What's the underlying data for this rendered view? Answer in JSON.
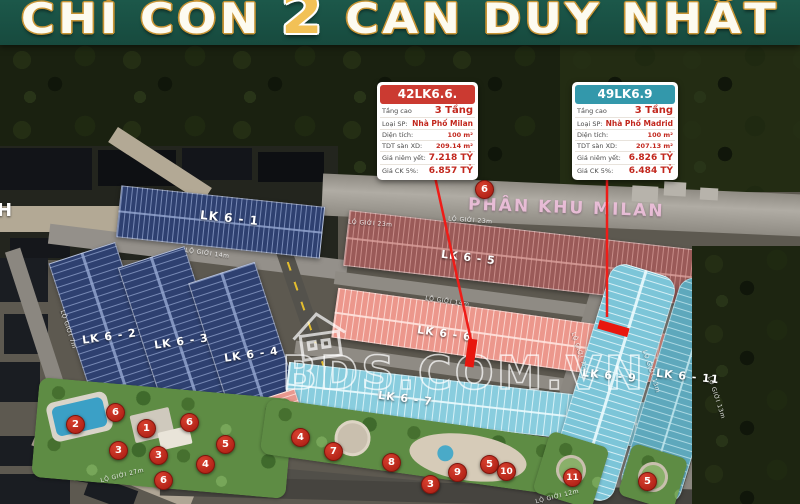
{
  "banner": {
    "prefix": "CHỈ CÒN",
    "highlight": "2",
    "suffix": "CĂN DUY NHẤT"
  },
  "zone_label": "PHÂN KHU MILAN",
  "watermark_text": "BDS.COM.VN",
  "edge_letter": "H",
  "cards": [
    {
      "title": "42LK6.6.",
      "header_color": "#cb3a31",
      "rows": [
        {
          "label": "Tầng cao",
          "value": "3 Tầng"
        },
        {
          "label": "Loại SP:",
          "value": "Nhà Phố Milan"
        },
        {
          "label": "Diện tích:",
          "value": "100 m²"
        },
        {
          "label": "TDT sàn XD:",
          "value": "209.14 m²"
        },
        {
          "label": "Giá niêm yết:",
          "value": "7.218 TỶ"
        },
        {
          "label": "Giá CK 5%:",
          "value": "6.857 TỶ"
        }
      ]
    },
    {
      "title": "49LK6.9",
      "header_color": "#3398ab",
      "rows": [
        {
          "label": "Tầng cao",
          "value": "3 Tầng"
        },
        {
          "label": "Loại SP:",
          "value": "Nhà Phố Madrid"
        },
        {
          "label": "Diện tích:",
          "value": "100 m²"
        },
        {
          "label": "TDT sàn XD:",
          "value": "207.13 m²"
        },
        {
          "label": "Giá niêm yết:",
          "value": "6.826 TỶ"
        },
        {
          "label": "Giá CK 5%:",
          "value": "6.484 TỶ"
        }
      ]
    }
  ],
  "blocks": [
    {
      "label": "LK 6 - 1"
    },
    {
      "label": "LK 6 - 2"
    },
    {
      "label": "LK 6 - 3"
    },
    {
      "label": "LK 6 - 4"
    },
    {
      "label": "LK 6 - 5"
    },
    {
      "label": "LK 6 - 6"
    },
    {
      "label": "LK 6 - 7"
    },
    {
      "label": "LK 6 - 9"
    },
    {
      "label": "LK 6 - 11"
    }
  ],
  "street_labels": [
    "LỘ GIỚI 23m",
    "LỘ GIỚI 23m",
    "LỘ GIỚI 14m",
    "LỘ GIỚI 14m",
    "LỘ GIỚI 27m",
    "LỘ GIỚI 12m",
    "LỘ GIỚI 7m",
    "LỘ GIỚI 7m",
    "LỘ GIỚI 13m",
    "LỘ GIỚI 13m"
  ],
  "badges": [
    "6",
    "2",
    "6",
    "1",
    "6",
    "3",
    "3",
    "5",
    "4",
    "6",
    "4",
    "7",
    "8",
    "3",
    "9",
    "5",
    "10",
    "11",
    "5"
  ],
  "colors": {
    "banner_green": "#1a5143",
    "title_gold": "#c79435",
    "highlight_lot_red": "#e8170f",
    "badge_red": "#c1231b",
    "card1_accent": "#cb3a31",
    "card2_accent": "#3398ab",
    "value_red": "#c2271d"
  }
}
